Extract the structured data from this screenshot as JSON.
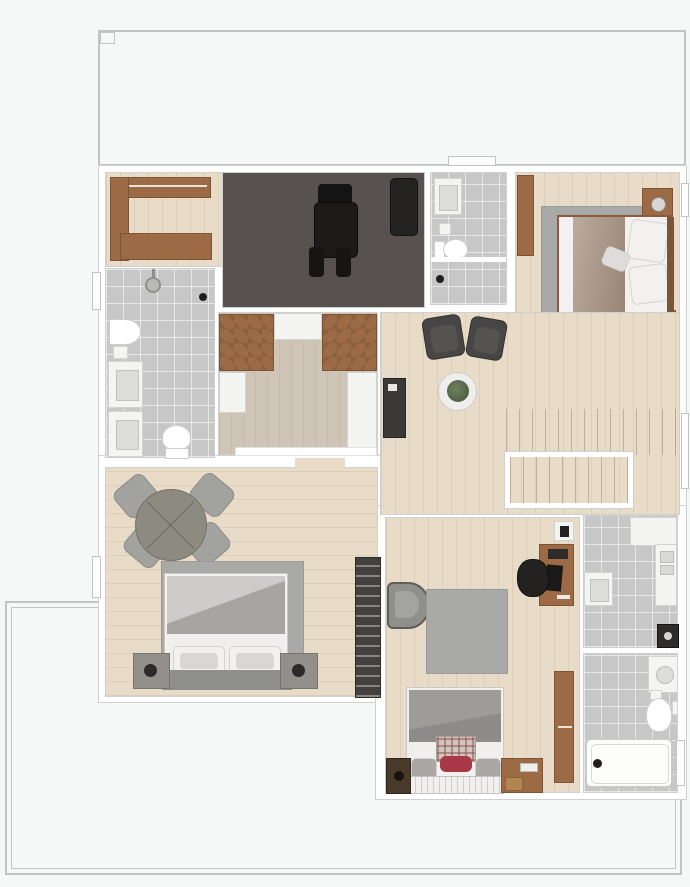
{
  "figure": {
    "type": "floor-plan",
    "view": "top-down-3d-render",
    "label": "furnished apartment upper-storey floor plan with terrace outlines"
  },
  "palette": {
    "bg": "#f6f7f7",
    "outline": "#c3c5c4",
    "wall": "#ffffff",
    "wall-edge": "#cfd1d0",
    "wood": "#e8dbc8",
    "wood2": "#e4d5c0",
    "darkfloor": "#575150",
    "tile": "#c7c7c7",
    "closetfloor": "#cfc5b6",
    "woodfurn": "#9c6b45",
    "woodfurndark": "#7d5435",
    "whitefurn": "#f4f4f2",
    "rug": "#a9a9a7",
    "darkchair": "#474645",
    "black": "#201f1e",
    "bedwhite": "#f2f1ef",
    "bedgray": "#b3b1ae",
    "headboard": "#8e8e8c",
    "accentred": "#a83848",
    "graychair": "#a2a29e",
    "plant": "#5a6b4f"
  },
  "rooms": [
    {
      "id": "dressing-nook",
      "floor": "wood",
      "furniture": [
        "c-shaped-wardrobe"
      ]
    },
    {
      "id": "media-room",
      "floor": "dark-carpet",
      "furniture": [
        "recliner",
        "bench"
      ]
    },
    {
      "id": "bathroom-top",
      "floor": "tile",
      "furniture": [
        "washbasin",
        "toilet",
        "shower-stall"
      ]
    },
    {
      "id": "bedroom-top-right",
      "floor": "wood",
      "furniture": [
        "wardrobe",
        "rug",
        "double-bed",
        "nightstand",
        "nightstand",
        "desk",
        "desk-chair"
      ]
    },
    {
      "id": "bathroom-left",
      "floor": "tile",
      "furniture": [
        "shower-head",
        "bidet",
        "washbasin",
        "washbasin",
        "toilet"
      ]
    },
    {
      "id": "walk-in-closet",
      "floor": "wood",
      "furniture": [
        "wardrobe-counter-left",
        "wardrobe-counter-right",
        "dresser-top",
        "dresser-left",
        "dresser-right"
      ]
    },
    {
      "id": "hallway-stairs",
      "floor": "wood",
      "furniture": [
        "armchair",
        "armchair",
        "round-table",
        "potted-plant",
        "console",
        "upper-stair-flight",
        "stairwell-railing"
      ]
    },
    {
      "id": "bedroom-bottom-left",
      "floor": "wood",
      "furniture": [
        "round-table",
        "chair",
        "chair",
        "chair",
        "chair",
        "rug",
        "double-bed",
        "nightstand",
        "nightstand",
        "shelf-unit"
      ]
    },
    {
      "id": "bedroom-bottom-middle",
      "floor": "wood",
      "furniture": [
        "wall-shelf",
        "desk",
        "office-chair",
        "armchair",
        "rug",
        "bed",
        "nightstand",
        "nightstand",
        "wall-shelf"
      ]
    },
    {
      "id": "bathroom-bottom-upper",
      "floor": "tile",
      "furniture": [
        "counter",
        "washbasin",
        "appliance"
      ]
    },
    {
      "id": "bathroom-bottom-lower",
      "floor": "tile",
      "furniture": [
        "washbasin",
        "toilet",
        "bathtub"
      ]
    }
  ]
}
